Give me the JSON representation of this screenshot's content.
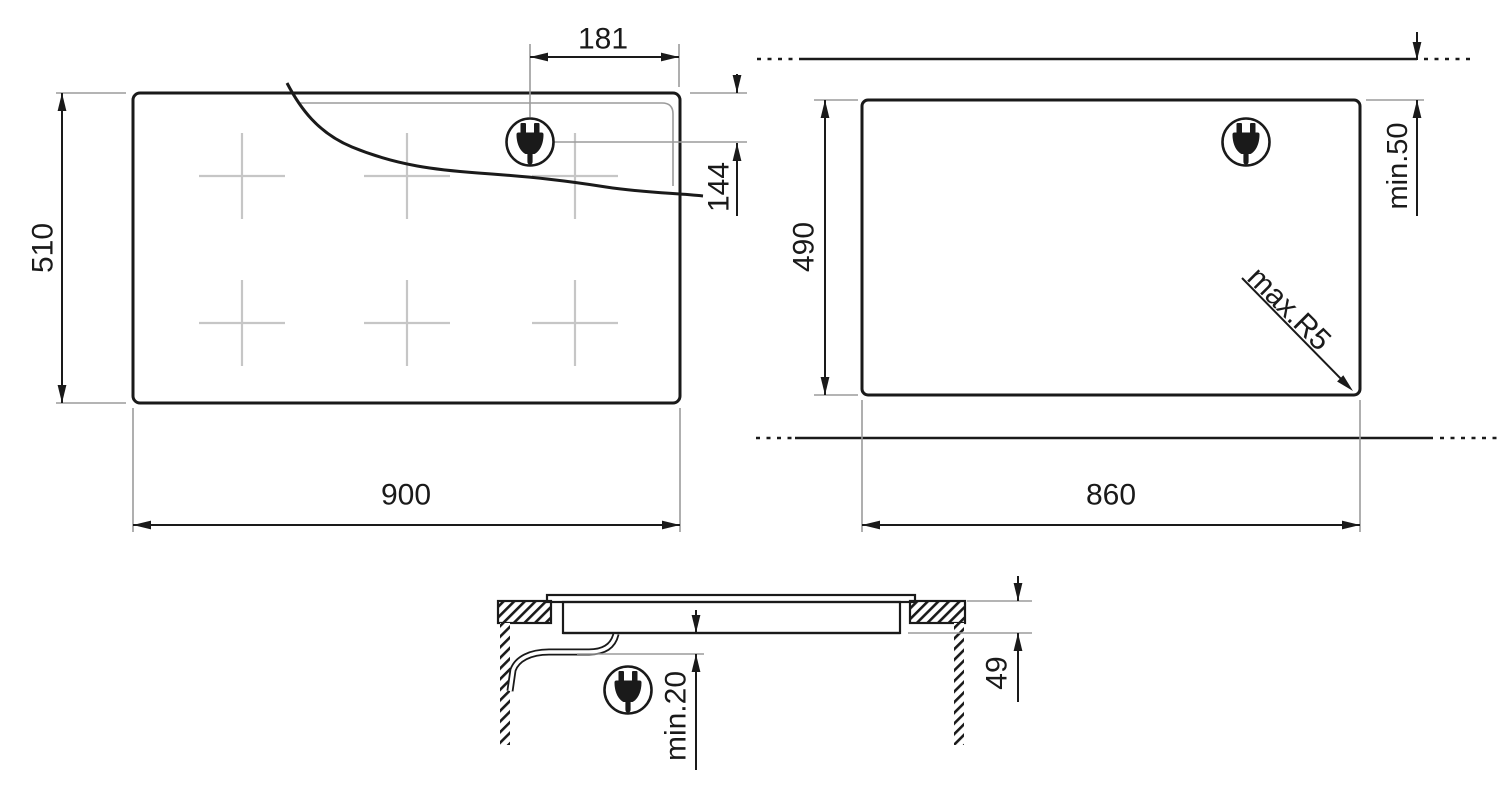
{
  "labels": {
    "top_view": {
      "width": "900",
      "height": "510",
      "plug_offset_x": "181",
      "plug_offset_y": "144"
    },
    "cutout_view": {
      "width": "860",
      "height": "490",
      "rear_clearance": "min.50",
      "corner_radius": "max.R5"
    },
    "section_view": {
      "under_clearance": "min.20",
      "recess_depth": "49"
    }
  },
  "icons": {
    "power_plug": "power-plug"
  },
  "colors": {
    "line": "#1a1a1a",
    "reference_line": "#9b9b9b",
    "zone_mark": "#c6c6c6",
    "background": "#ffffff"
  }
}
